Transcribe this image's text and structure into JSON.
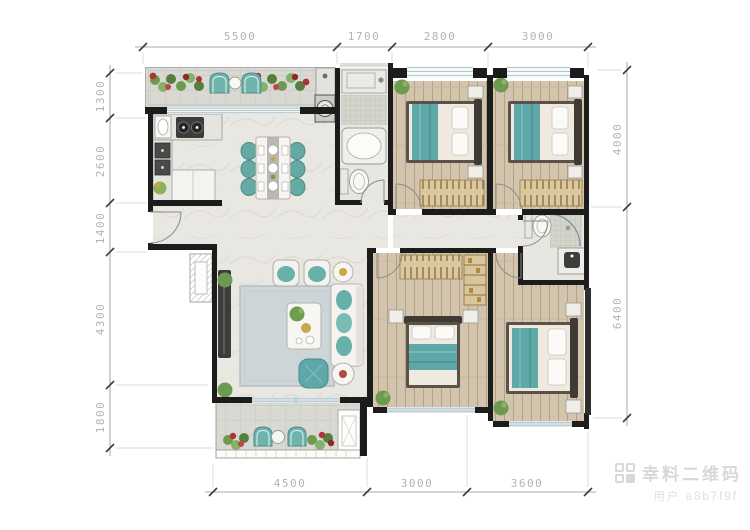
{
  "dimensions": {
    "top": [
      "5500",
      "1700",
      "2800",
      "3000"
    ],
    "left": [
      "1300",
      "2600",
      "1400",
      "4300",
      "1800"
    ],
    "right": [
      "4000",
      "6400"
    ],
    "bottom": [
      "4500",
      "3000",
      "3600"
    ]
  },
  "watermark": {
    "title": "幸料二维码",
    "subtitle": "用户 a8b7f9f",
    "icon": "qr-grid-icon"
  },
  "colors": {
    "wall": "#1c1c1c",
    "accent_teal": "#66aaa4",
    "wood_floor": "#d3c5ad",
    "marble_floor": "#e9e7e2",
    "tile_floor": "#d9d9d3",
    "wardrobe_tan": "#dbc89f",
    "flower_red": "#aa3535",
    "plant_green": "#6d9a50",
    "dim_line": "#8f8f8f",
    "dim_text": "#b3b3b3",
    "watermark_gray": "#d8d8d8"
  }
}
